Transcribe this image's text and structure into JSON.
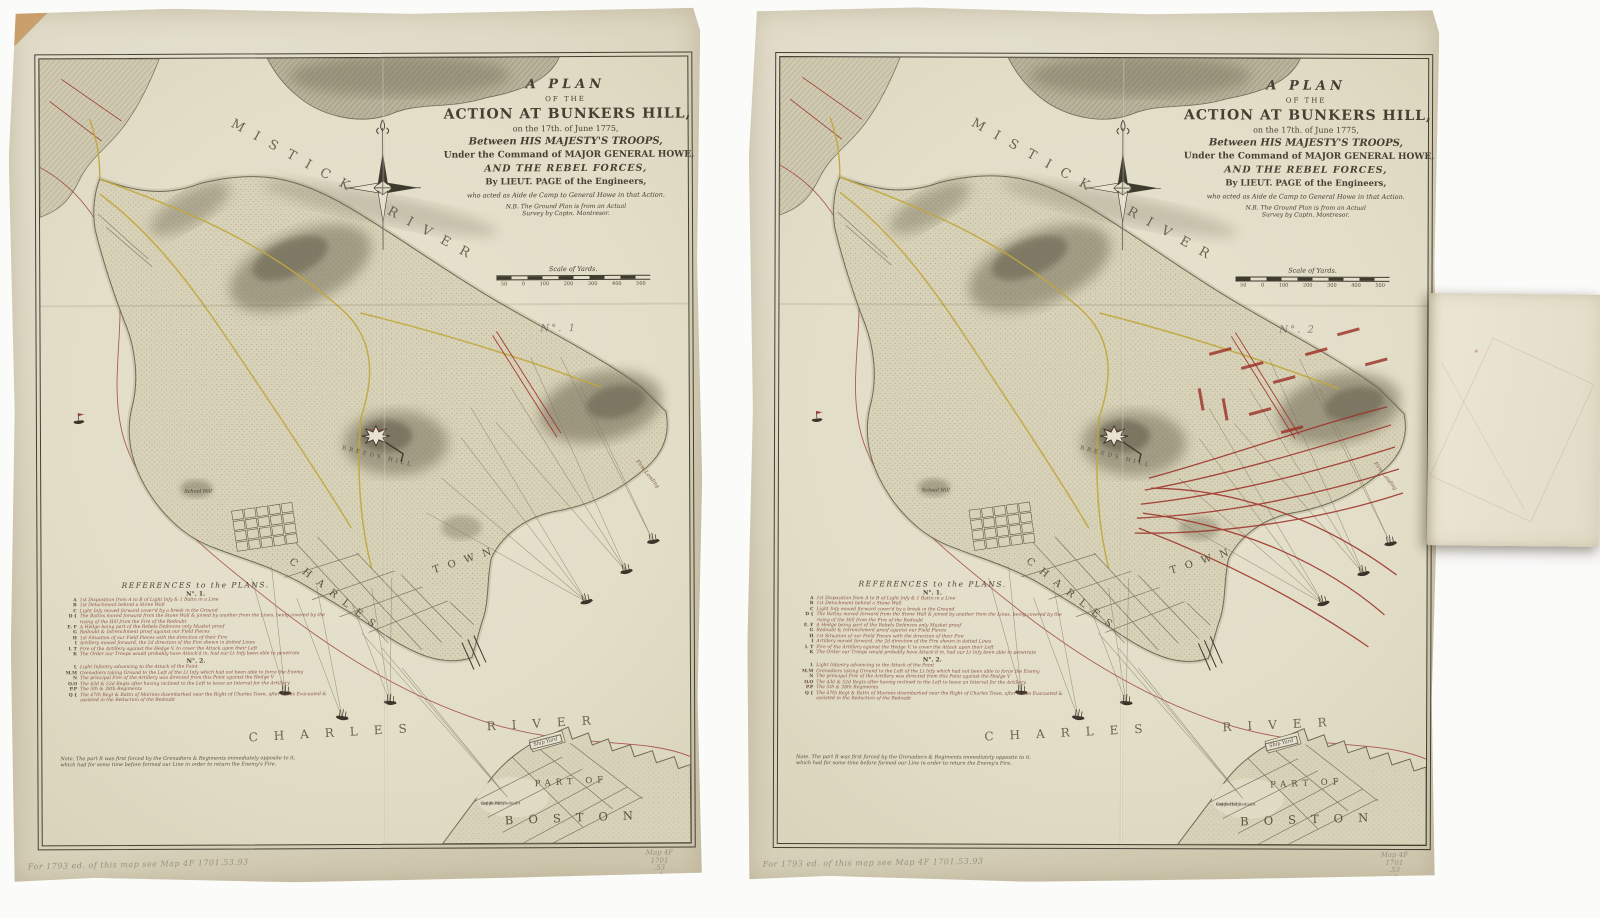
{
  "colors": {
    "paper": "#dcd6c0",
    "plate_field": "#e4e0cb",
    "ink": "#454032",
    "red_ink": "#9e3a32",
    "yellow_road": "#c2a73c",
    "pencil": "#97917f"
  },
  "map": {
    "title": {
      "l1": "A PLAN",
      "l2": "OF THE",
      "l3": "ACTION AT BUNKERS HILL,",
      "l4": "on the 17th. of June 1775,",
      "l5": "Between HIS MAJESTY'S TROOPS,",
      "l6": "Under the Command of MAJOR GENERAL HOWE,",
      "l7": "AND THE REBEL FORCES,",
      "l8": "By LIEUT. PAGE of the Engineers,",
      "l9": "who acted as Aide de Camp to General Howe in that Action.",
      "l10": "N.B. The Ground Plan is from an Actual",
      "l11": "Survey by Captn. Montresor."
    },
    "scale": {
      "label": "Scale of Yards.",
      "ticks": "50 0 100 200 300 400 500"
    },
    "labels": {
      "mistick_a": "MISTICK",
      "mistick_b": "RIVER",
      "charles_river_a": "CHARLES",
      "charles_river_b": "RIVER",
      "charlestown_a": "CHARLES",
      "charlestown_b": "TOWN",
      "part_of": "PART OF",
      "boston": "BOSTON",
      "ship_yard": "Ship Yard",
      "school_hill": "School Hill",
      "first_landing": "First Landing",
      "breeds_hill": "BREEDS HILL",
      "copps_a": "Copps Hill Redoubt",
      "copps_b": "and Battery"
    },
    "legend": {
      "heading": "REFERENCES to the PLANS.",
      "no1_heading": "N°. 1.",
      "no2_heading": "N°. 2.",
      "no1": [
        {
          "key": "A",
          "text": "1st Disposition from A to B of Light Infy & 1 Battn in a Line"
        },
        {
          "key": "B",
          "text": "1st Detachment behind a Stone Wall"
        },
        {
          "key": "C",
          "text": "Light Infy moved forward cover'd by a break in the Ground"
        },
        {
          "key": "D {",
          "text": "The Battns moved forward from the Stone Wall & joined by another from the Lines, being covered by the rising of the Hill from the Fire of the Redoubt"
        },
        {
          "key": "E. F",
          "text": "A Hedge being part of the Rebels Defences only Musket proof"
        },
        {
          "key": "G",
          "text": "Redoubt & Intrenchment proof against our Field Pieces"
        },
        {
          "key": "H",
          "text": "1st Situation of our Field Pieces with the direction of their Fire"
        },
        {
          "key": "I",
          "text": "Artillery moved forward, the 2d direction of the Fire shewn in dotted Lines"
        },
        {
          "key": "I. T",
          "text": "Fire of the Artillery against the Hedge V, to cover the Attack upon their Left"
        },
        {
          "key": "K",
          "text": "The Order our Troops would probably have Attack'd in, had our Lt Infy been able to penetrate"
        }
      ],
      "no2": [
        {
          "key": "L",
          "text": "Light Infantry advancing to the Attack of the Point"
        },
        {
          "key": "M.M",
          "text": "Grenadiers taking Ground to the Left of the Lt Infy which had not been able to force the Enemy"
        },
        {
          "key": "N",
          "text": "The principal Fire of the Artillery was directed from this Point against the Hedge V"
        },
        {
          "key": "O.O",
          "text": "The 43d & 52d Regts after having inclined to the Left to leave an Interval for the Artillery"
        },
        {
          "key": "P.P",
          "text": "The 5th & 38th Regiments"
        },
        {
          "key": "Q {",
          "text": "The 47th Regt & Battn of Marines disembarked near the Right of Charles Town, after it was Evacuated & assisted in the Reduction of the Redoubt"
        }
      ],
      "note1": "Note. The part R was first forced by the Grenadiers & Regiments immediately opposite to it,",
      "note2": "which had for some time before formed our Line in order to return the Enemy's Fire."
    }
  },
  "sheets": [
    {
      "plan_number": "N°. 1"
    },
    {
      "plan_number": "N°. 2"
    }
  ],
  "annotations": {
    "pencil_note": "For 1793 ed. of this map see Map 4F 1701.53.93",
    "shelfmark1": "Map 4F",
    "shelfmark2": "1701",
    "shelfmark3": ".53",
    "shelfmark4": ".3"
  }
}
